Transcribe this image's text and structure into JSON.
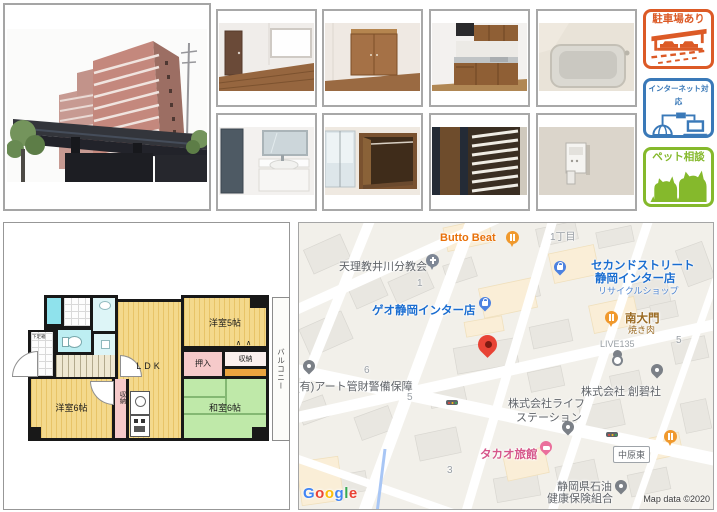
{
  "badges": [
    {
      "label": "駐車場あり",
      "color": "#dc5a26",
      "icon": "carport-icon"
    },
    {
      "label": "インターネット対応",
      "color": "#3a79b8",
      "icon": "globe-laptop-icon"
    },
    {
      "label": "ペット相談",
      "color": "#85b92c",
      "icon": "dogs-icon"
    }
  ],
  "floorplan": {
    "ldk": "LDK",
    "western5": "洋室5帖",
    "western6": "洋室6帖",
    "japanese6": "和室6帖",
    "oshiire": "押入",
    "storage_right": "収納",
    "storage_mid": "収納",
    "balcony": "バルコニー",
    "shoebox": "下足箱",
    "vent_marks": "∧∧"
  },
  "map": {
    "pois": {
      "butto_beat": "Butto Beat",
      "tenrikyo": "天理教井川分教会",
      "geo": "ゲオ静岡インター店",
      "chome": "1丁目",
      "second_street_1": "セカンドストリート",
      "second_street_2": "静岡インター店",
      "second_street_3": "リサイクルショップ",
      "minamidaimon": "南大門",
      "yakiniku": "焼き肉",
      "live135": "LIVE135",
      "art_keibi": "(有)アート管財警備保障",
      "takao": "タカオ旅館",
      "life_1": "株式会社ライフ",
      "life_2": "ステーション",
      "soheki": "株式会社 創碧社",
      "nakahara": "中原東",
      "sekiyu_1": "静岡県石油",
      "sekiyu_2": "健康保険組合",
      "num_1": "1",
      "num_6": "6",
      "num_5a": "5",
      "num_5b": "5",
      "num_3": "3"
    },
    "logo": "Google",
    "attribution": "Map data ©2020"
  }
}
